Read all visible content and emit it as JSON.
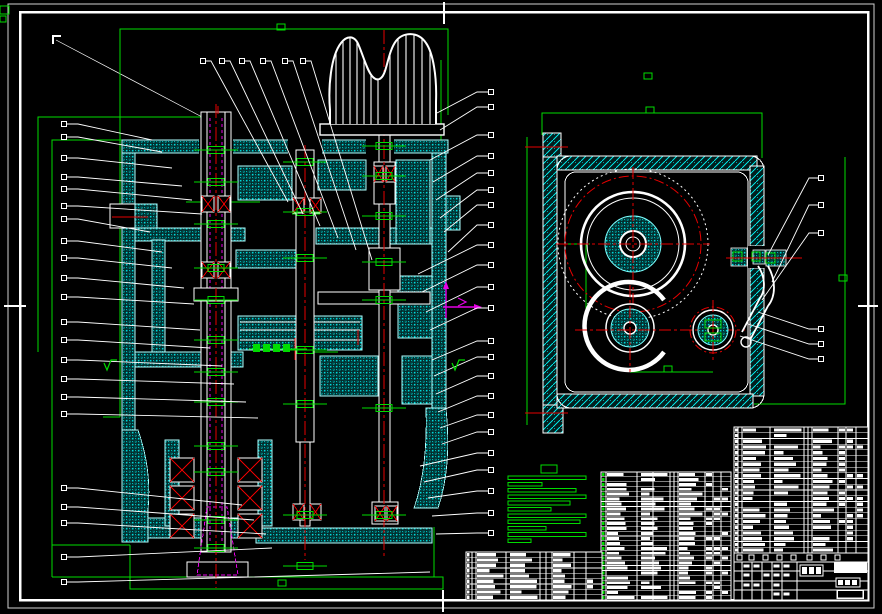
{
  "sheet": {
    "description": "CAD assembly drawing, front section view of gearbox head (left), side view of housing with gears (right), parts list tables and title block (bottom right), technical-requirements note block (green), balloon callouts around both views",
    "background": "#000000"
  },
  "palette": {
    "white": "#ffffff",
    "cyan": "#00e0e0",
    "cyan_bright": "#7dffff",
    "green": "#00dc00",
    "red": "#e60000",
    "magenta": "#e600e6"
  },
  "callouts": {
    "left": [
      {
        "y": 124,
        "tx": 152,
        "ty": 140
      },
      {
        "y": 137,
        "tx": 162,
        "ty": 152
      },
      {
        "y": 158,
        "tx": 172,
        "ty": 168
      },
      {
        "y": 177,
        "tx": 182,
        "ty": 186
      },
      {
        "y": 189,
        "tx": 192,
        "ty": 200
      },
      {
        "y": 206,
        "tx": 202,
        "ty": 214
      },
      {
        "y": 219,
        "tx": 150,
        "ty": 232
      },
      {
        "y": 241,
        "tx": 162,
        "ty": 252
      },
      {
        "y": 258,
        "tx": 172,
        "ty": 268
      },
      {
        "y": 278,
        "tx": 184,
        "ty": 288
      },
      {
        "y": 297,
        "tx": 194,
        "ty": 304
      },
      {
        "y": 322,
        "tx": 200,
        "ty": 330
      },
      {
        "y": 340,
        "tx": 210,
        "ty": 348
      },
      {
        "y": 360,
        "tx": 222,
        "ty": 366
      },
      {
        "y": 379,
        "tx": 234,
        "ty": 384
      },
      {
        "y": 397,
        "tx": 246,
        "ty": 402
      },
      {
        "y": 414,
        "tx": 258,
        "ty": 418
      },
      {
        "y": 488,
        "tx": 242,
        "ty": 505
      },
      {
        "y": 507,
        "tx": 254,
        "ty": 520
      },
      {
        "y": 523,
        "tx": 266,
        "ty": 534
      },
      {
        "y": 557,
        "tx": 272,
        "ty": 548
      },
      {
        "y": 582,
        "tx": 430,
        "ty": 572
      }
    ],
    "top": [
      {
        "x": 203,
        "tx": 288,
        "ty": 202
      },
      {
        "x": 222,
        "tx": 303,
        "ty": 214
      },
      {
        "x": 242,
        "tx": 320,
        "ty": 226
      },
      {
        "x": 263,
        "tx": 338,
        "ty": 238
      },
      {
        "x": 285,
        "tx": 356,
        "ty": 250
      },
      {
        "x": 303,
        "tx": 372,
        "ty": 260
      }
    ],
    "mid": [
      {
        "y": 92,
        "tx": 437,
        "ty": 113
      },
      {
        "y": 107,
        "tx": 440,
        "ty": 130
      },
      {
        "y": 135,
        "tx": 430,
        "ty": 160
      },
      {
        "y": 156,
        "tx": 433,
        "ty": 182
      },
      {
        "y": 173,
        "tx": 436,
        "ty": 200
      },
      {
        "y": 190,
        "tx": 440,
        "ty": 218
      },
      {
        "y": 205,
        "tx": 444,
        "ty": 232
      },
      {
        "y": 225,
        "tx": 448,
        "ty": 252
      },
      {
        "y": 245,
        "tx": 418,
        "ty": 274
      },
      {
        "y": 265,
        "tx": 422,
        "ty": 292
      },
      {
        "y": 287,
        "tx": 426,
        "ty": 312
      },
      {
        "y": 308,
        "tx": 430,
        "ty": 330
      },
      {
        "y": 341,
        "tx": 432,
        "ty": 360
      },
      {
        "y": 357,
        "tx": 434,
        "ty": 376
      },
      {
        "y": 376,
        "tx": 436,
        "ty": 394
      },
      {
        "y": 396,
        "tx": 438,
        "ty": 412
      },
      {
        "y": 415,
        "tx": 440,
        "ty": 428
      },
      {
        "y": 432,
        "tx": 442,
        "ty": 444
      },
      {
        "y": 453,
        "tx": 420,
        "ty": 466
      },
      {
        "y": 470,
        "tx": 424,
        "ty": 482
      },
      {
        "y": 491,
        "tx": 428,
        "ty": 498
      },
      {
        "y": 513,
        "tx": 432,
        "ty": 516
      },
      {
        "y": 533,
        "tx": 436,
        "ty": 534
      }
    ],
    "right": [
      {
        "y": 178,
        "tx": 768,
        "ty": 255
      },
      {
        "y": 205,
        "tx": 772,
        "ty": 282
      },
      {
        "y": 233,
        "tx": 762,
        "ty": 300
      },
      {
        "y": 329,
        "tx": 758,
        "ty": 312
      },
      {
        "y": 344,
        "tx": 748,
        "ty": 324
      },
      {
        "y": 359,
        "tx": 740,
        "ty": 336
      }
    ]
  },
  "green_markers": [
    [
      281,
      27
    ],
    [
      650,
      110
    ],
    [
      648,
      76
    ],
    [
      843,
      278
    ],
    [
      668,
      369
    ],
    [
      282,
      583
    ]
  ],
  "finish_marks": [
    [
      452,
      363
    ],
    [
      104,
      363
    ]
  ],
  "dim_text_cluster": {
    "x": 253,
    "y": 344,
    "line_x2": 307,
    "blocks": 4
  },
  "tech_requirements": {
    "title_box": [
      541,
      465,
      16,
      8
    ],
    "line_x": 508,
    "line_start_y": 476,
    "line_step": 6.3,
    "line_h": 3.6,
    "line_widths": [
      78,
      34,
      68,
      78,
      62,
      43,
      78,
      72,
      38,
      78,
      23
    ]
  },
  "tables": {
    "bom_right": {
      "x": 734,
      "y": 427,
      "w": 134,
      "h": 126,
      "rows": 22,
      "cols": [
        4,
        8,
        36,
        70,
        74,
        78,
        104,
        112,
        122
      ],
      "text_cols": [
        [
          9,
          35
        ],
        [
          40,
          69
        ],
        [
          79,
          103
        ]
      ],
      "narrow_cols": [
        [
          105,
          111
        ],
        [
          113,
          121
        ],
        [
          123,
          132
        ]
      ],
      "seed": 7
    },
    "bom_middle": {
      "x": 601,
      "y": 472,
      "w": 130,
      "h": 128,
      "rows": 26,
      "cols": [
        5,
        36,
        52,
        69,
        73,
        77,
        104,
        112,
        120
      ],
      "text_cols": [
        [
          6,
          35
        ],
        [
          40,
          68
        ],
        [
          78,
          103
        ]
      ],
      "narrow_cols": [
        [
          105,
          111
        ],
        [
          113,
          119
        ],
        [
          121,
          129
        ]
      ],
      "seed": 13,
      "first_col_green": true
    },
    "bom_bottom": {
      "x": 466,
      "y": 552,
      "w": 136,
      "h": 48,
      "rows": 9,
      "cols": [
        6,
        10,
        40,
        74,
        80,
        86,
        108,
        120
      ],
      "text_cols": [
        [
          11,
          39
        ],
        [
          44,
          73
        ],
        [
          87,
          107
        ]
      ],
      "narrow_cols": [
        [
          121,
          134
        ]
      ],
      "seed": 21
    }
  },
  "title_block": {
    "x": 734,
    "y": 553,
    "w": 134,
    "h": 47,
    "hlines": [
      9,
      18,
      28,
      37
    ],
    "vlines": [
      8,
      18,
      28,
      38,
      48,
      63
    ],
    "header_squares": [
      737,
      749,
      763,
      777,
      791,
      807,
      821,
      835
    ],
    "chips": [
      {
        "type": "glyph-dark",
        "x": 800,
        "y": 565,
        "w": 23,
        "h": 11
      },
      {
        "type": "white-fill",
        "x": 834,
        "y": 562,
        "w": 33,
        "h": 11
      },
      {
        "type": "glyph-dark",
        "x": 836,
        "y": 578,
        "w": 24,
        "h": 9
      },
      {
        "type": "outline",
        "x": 837,
        "y": 590,
        "w": 26,
        "h": 8
      }
    ],
    "seed": 31
  }
}
